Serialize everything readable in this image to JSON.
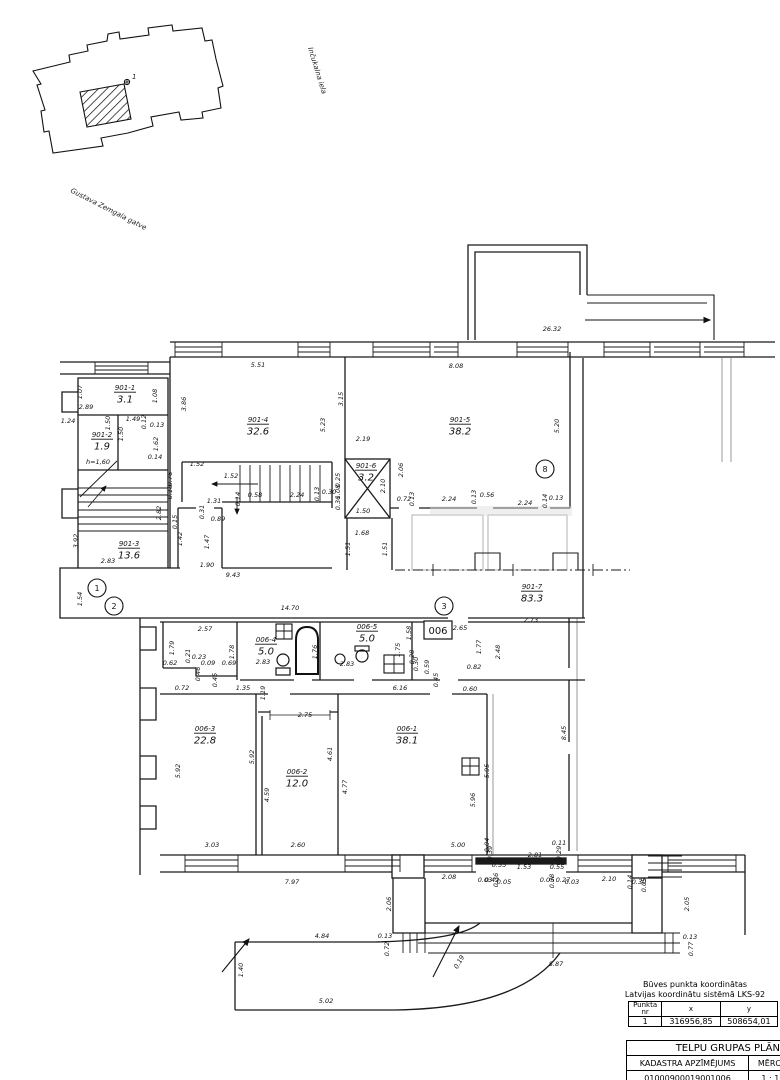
{
  "site_plan": {
    "street_1": "Inčukalna iela",
    "street_2": "Gustava Zemgala gatve",
    "point_label": "1"
  },
  "plan": {
    "group_box_label": "006",
    "rooms": [
      {
        "id": "901-1",
        "area": "3.1",
        "x": 125,
        "y": 390
      },
      {
        "id": "901-2",
        "area": "1.9",
        "x": 102,
        "y": 437
      },
      {
        "id": "901-3",
        "area": "13.6",
        "x": 129,
        "y": 546
      },
      {
        "id": "901-4",
        "area": "32.6",
        "x": 258,
        "y": 422
      },
      {
        "id": "901-5",
        "area": "38.2",
        "x": 460,
        "y": 422
      },
      {
        "id": "901-6",
        "area": "3.2",
        "x": 366,
        "y": 468
      },
      {
        "id": "901-7",
        "area": "83.3",
        "x": 532,
        "y": 589
      },
      {
        "id": "006-1",
        "area": "38.1",
        "x": 407,
        "y": 731
      },
      {
        "id": "006-2",
        "area": "12.0",
        "x": 297,
        "y": 774
      },
      {
        "id": "006-3",
        "area": "22.8",
        "x": 205,
        "y": 731
      },
      {
        "id": "006-4",
        "area": "5.0",
        "x": 266,
        "y": 642
      },
      {
        "id": "006-5",
        "area": "5.0",
        "x": 367,
        "y": 629
      }
    ],
    "markers": [
      {
        "n": "1",
        "x": 97,
        "y": 588
      },
      {
        "n": "2",
        "x": 114,
        "y": 606
      },
      {
        "n": "3",
        "x": 444,
        "y": 606
      },
      {
        "n": "8",
        "x": 545,
        "y": 469
      }
    ],
    "dimensions": [
      {
        "t": "26.32",
        "x": 552,
        "y": 331
      },
      {
        "t": "5.51",
        "x": 258,
        "y": 367
      },
      {
        "t": "8.08",
        "x": 456,
        "y": 368
      },
      {
        "t": "3.86",
        "x": 186,
        "y": 404,
        "r": -90
      },
      {
        "t": "3.15",
        "x": 343,
        "y": 399,
        "r": -90
      },
      {
        "t": "5.23",
        "x": 325,
        "y": 425,
        "r": -90
      },
      {
        "t": "5.20",
        "x": 559,
        "y": 426,
        "r": -90
      },
      {
        "t": "1.07",
        "x": 82,
        "y": 392,
        "r": -90
      },
      {
        "t": "1.08",
        "x": 157,
        "y": 396,
        "r": -90
      },
      {
        "t": "2.89",
        "x": 86,
        "y": 409
      },
      {
        "t": "1.24",
        "x": 68,
        "y": 423
      },
      {
        "t": "1.50",
        "x": 110,
        "y": 423,
        "r": -90
      },
      {
        "t": "1.49",
        "x": 133,
        "y": 421
      },
      {
        "t": "0.12",
        "x": 146,
        "y": 422,
        "r": -90
      },
      {
        "t": "0.13",
        "x": 157,
        "y": 427
      },
      {
        "t": "1.50",
        "x": 123,
        "y": 434,
        "r": -90
      },
      {
        "t": "1.62",
        "x": 158,
        "y": 444,
        "r": -90
      },
      {
        "t": "h=1,60",
        "x": 98,
        "y": 464
      },
      {
        "t": "0.14",
        "x": 155,
        "y": 459
      },
      {
        "t": "0.76",
        "x": 172,
        "y": 479,
        "r": -90
      },
      {
        "t": "3.92",
        "x": 78,
        "y": 541,
        "r": -90
      },
      {
        "t": "2.82",
        "x": 161,
        "y": 513,
        "r": -90
      },
      {
        "t": "2.83",
        "x": 108,
        "y": 563
      },
      {
        "t": "9.43",
        "x": 233,
        "y": 577
      },
      {
        "t": "1.54",
        "x": 82,
        "y": 599,
        "r": -90
      },
      {
        "t": "1.52",
        "x": 197,
        "y": 466
      },
      {
        "t": "1.52",
        "x": 231,
        "y": 478
      },
      {
        "t": "1.31",
        "x": 214,
        "y": 503
      },
      {
        "t": "0.14",
        "x": 240,
        "y": 499,
        "r": -90
      },
      {
        "t": "0.58",
        "x": 255,
        "y": 497
      },
      {
        "t": "2.24",
        "x": 297,
        "y": 497
      },
      {
        "t": "0.13",
        "x": 319,
        "y": 494,
        "r": -90
      },
      {
        "t": "0.30",
        "x": 329,
        "y": 494
      },
      {
        "t": "0.31",
        "x": 204,
        "y": 512,
        "r": -90
      },
      {
        "t": "1.42",
        "x": 182,
        "y": 539,
        "r": -90
      },
      {
        "t": "1.47",
        "x": 209,
        "y": 542,
        "r": -90
      },
      {
        "t": "1.90",
        "x": 207,
        "y": 567
      },
      {
        "t": "0.15",
        "x": 177,
        "y": 522,
        "r": -90
      },
      {
        "t": "0.89",
        "x": 218,
        "y": 521
      },
      {
        "t": "0.25",
        "x": 340,
        "y": 480,
        "r": -90
      },
      {
        "t": "1.08",
        "x": 340,
        "y": 492,
        "r": -90
      },
      {
        "t": "0.36",
        "x": 340,
        "y": 503,
        "r": -90
      },
      {
        "t": "0.18",
        "x": 172,
        "y": 492,
        "r": -90
      },
      {
        "t": "2.19",
        "x": 363,
        "y": 441
      },
      {
        "t": "2.06",
        "x": 403,
        "y": 470,
        "r": -90
      },
      {
        "t": "2.10",
        "x": 385,
        "y": 486,
        "r": -90
      },
      {
        "t": "1.50",
        "x": 363,
        "y": 513
      },
      {
        "t": "1.68",
        "x": 362,
        "y": 535
      },
      {
        "t": "1.51",
        "x": 350,
        "y": 549,
        "r": -90
      },
      {
        "t": "1.51",
        "x": 387,
        "y": 549,
        "r": -90
      },
      {
        "t": "0.72",
        "x": 404,
        "y": 501
      },
      {
        "t": "0.13",
        "x": 414,
        "y": 499,
        "r": -90
      },
      {
        "t": "2.24",
        "x": 449,
        "y": 501
      },
      {
        "t": "0.13",
        "x": 476,
        "y": 497,
        "r": -90
      },
      {
        "t": "0.56",
        "x": 487,
        "y": 497
      },
      {
        "t": "2.24",
        "x": 525,
        "y": 505
      },
      {
        "t": "0.14",
        "x": 547,
        "y": 501,
        "r": -90
      },
      {
        "t": "0.13",
        "x": 556,
        "y": 500
      },
      {
        "t": "2.73",
        "x": 531,
        "y": 622
      },
      {
        "t": "14.70",
        "x": 290,
        "y": 610
      },
      {
        "t": "2.65",
        "x": 460,
        "y": 630
      },
      {
        "t": "1.77",
        "x": 481,
        "y": 647,
        "r": -90
      },
      {
        "t": "2.48",
        "x": 500,
        "y": 652,
        "r": -90
      },
      {
        "t": "0.82",
        "x": 474,
        "y": 669
      },
      {
        "t": "8.45",
        "x": 566,
        "y": 733,
        "r": -90
      },
      {
        "t": "2.57",
        "x": 205,
        "y": 631
      },
      {
        "t": "1.79",
        "x": 174,
        "y": 648,
        "r": -90
      },
      {
        "t": "1.78",
        "x": 234,
        "y": 652,
        "r": -90
      },
      {
        "t": "0.21",
        "x": 190,
        "y": 656,
        "r": -90
      },
      {
        "t": "0.23",
        "x": 199,
        "y": 659
      },
      {
        "t": "0.62",
        "x": 170,
        "y": 665
      },
      {
        "t": "0.09",
        "x": 208,
        "y": 665
      },
      {
        "t": "0.46",
        "x": 200,
        "y": 674,
        "r": -90
      },
      {
        "t": "0.69",
        "x": 229,
        "y": 665
      },
      {
        "t": "0.45",
        "x": 217,
        "y": 680,
        "r": -90
      },
      {
        "t": "2.83",
        "x": 263,
        "y": 664
      },
      {
        "t": "1.76",
        "x": 317,
        "y": 652,
        "r": -90
      },
      {
        "t": "2.83",
        "x": 347,
        "y": 666
      },
      {
        "t": "1.75",
        "x": 400,
        "y": 650,
        "r": -90
      },
      {
        "t": "1.58",
        "x": 411,
        "y": 633,
        "r": -90
      },
      {
        "t": "0.28",
        "x": 414,
        "y": 657,
        "r": -90
      },
      {
        "t": "0.30",
        "x": 418,
        "y": 664,
        "r": -90
      },
      {
        "t": "0.59",
        "x": 429,
        "y": 667,
        "r": -90
      },
      {
        "t": "0.45",
        "x": 438,
        "y": 680,
        "r": -90
      },
      {
        "t": "1.35",
        "x": 243,
        "y": 690
      },
      {
        "t": "1.19",
        "x": 265,
        "y": 693,
        "r": -90
      },
      {
        "t": "6.16",
        "x": 400,
        "y": 690
      },
      {
        "t": "0.60",
        "x": 470,
        "y": 691
      },
      {
        "t": "0.72",
        "x": 182,
        "y": 690
      },
      {
        "t": "5.92",
        "x": 180,
        "y": 771,
        "r": -90
      },
      {
        "t": "5.92",
        "x": 254,
        "y": 757,
        "r": -90
      },
      {
        "t": "3.03",
        "x": 212,
        "y": 847
      },
      {
        "t": "2.75",
        "x": 305,
        "y": 717
      },
      {
        "t": "4.61",
        "x": 332,
        "y": 754,
        "r": -90
      },
      {
        "t": "4.59",
        "x": 269,
        "y": 795,
        "r": -90
      },
      {
        "t": "4.77",
        "x": 347,
        "y": 787,
        "r": -90
      },
      {
        "t": "2.60",
        "x": 298,
        "y": 847
      },
      {
        "t": "5.96",
        "x": 475,
        "y": 800,
        "r": -90
      },
      {
        "t": "5.95",
        "x": 489,
        "y": 771,
        "r": -90
      },
      {
        "t": "5.00",
        "x": 458,
        "y": 847
      },
      {
        "t": "7.97",
        "x": 292,
        "y": 884
      },
      {
        "t": "2.08",
        "x": 449,
        "y": 879
      },
      {
        "t": "0.03",
        "x": 485,
        "y": 882
      },
      {
        "t": "0.42",
        "x": 492,
        "y": 882
      },
      {
        "t": "0.36",
        "x": 498,
        "y": 880,
        "r": -90
      },
      {
        "t": "0.05",
        "x": 504,
        "y": 884
      },
      {
        "t": "0.05",
        "x": 547,
        "y": 882
      },
      {
        "t": "0.38",
        "x": 554,
        "y": 881,
        "r": -90
      },
      {
        "t": "0.27",
        "x": 563,
        "y": 882
      },
      {
        "t": "0.03",
        "x": 572,
        "y": 884
      },
      {
        "t": "2.10",
        "x": 609,
        "y": 881
      },
      {
        "t": "0.14",
        "x": 632,
        "y": 882,
        "r": -90
      },
      {
        "t": "0.30",
        "x": 639,
        "y": 884
      },
      {
        "t": "0.05",
        "x": 646,
        "y": 885,
        "r": -90
      },
      {
        "t": "0.04",
        "x": 489,
        "y": 845,
        "r": -90
      },
      {
        "t": "0.39",
        "x": 492,
        "y": 853,
        "r": -90
      },
      {
        "t": "0.11",
        "x": 559,
        "y": 845
      },
      {
        "t": "0.29",
        "x": 561,
        "y": 853,
        "r": -90
      },
      {
        "t": "0.55",
        "x": 499,
        "y": 867
      },
      {
        "t": "1.53",
        "x": 524,
        "y": 869
      },
      {
        "t": "0.55",
        "x": 557,
        "y": 869
      },
      {
        "t": "2.81",
        "x": 535,
        "y": 857
      },
      {
        "t": "2.06",
        "x": 391,
        "y": 904,
        "r": -90
      },
      {
        "t": "2.05",
        "x": 689,
        "y": 904,
        "r": -90
      },
      {
        "t": "0.13",
        "x": 385,
        "y": 938
      },
      {
        "t": "0.72",
        "x": 389,
        "y": 949,
        "r": -90
      },
      {
        "t": "0.13",
        "x": 690,
        "y": 939
      },
      {
        "t": "0.77",
        "x": 693,
        "y": 949,
        "r": -90
      },
      {
        "t": "8.87",
        "x": 556,
        "y": 966
      },
      {
        "t": "0.19",
        "x": 461,
        "y": 963,
        "r": -60
      },
      {
        "t": "4.84",
        "x": 322,
        "y": 938
      },
      {
        "t": "1.40",
        "x": 243,
        "y": 970,
        "r": -90
      },
      {
        "t": "5.02",
        "x": 326,
        "y": 1003
      }
    ]
  },
  "coord_table": {
    "caption_line1": "Būves punkta koordinātas",
    "caption_line2": "Latvijas koordinātu sistēmā LKS-92",
    "col_point": "Punkta nr",
    "col_x": "x",
    "col_y": "y",
    "row_point": "1",
    "row_x": "316956,85",
    "row_y": "508654,01"
  },
  "title_block": {
    "title": "TELPU GRUPAS PLĀNS",
    "cadastre_label": "KADASTRA APZĪMĒJUMS",
    "scale_label": "MĒROGS",
    "page_label": "LP",
    "cadastre_value": "01000900019001006",
    "scale_value": "1 : 100",
    "page_value": "4"
  }
}
